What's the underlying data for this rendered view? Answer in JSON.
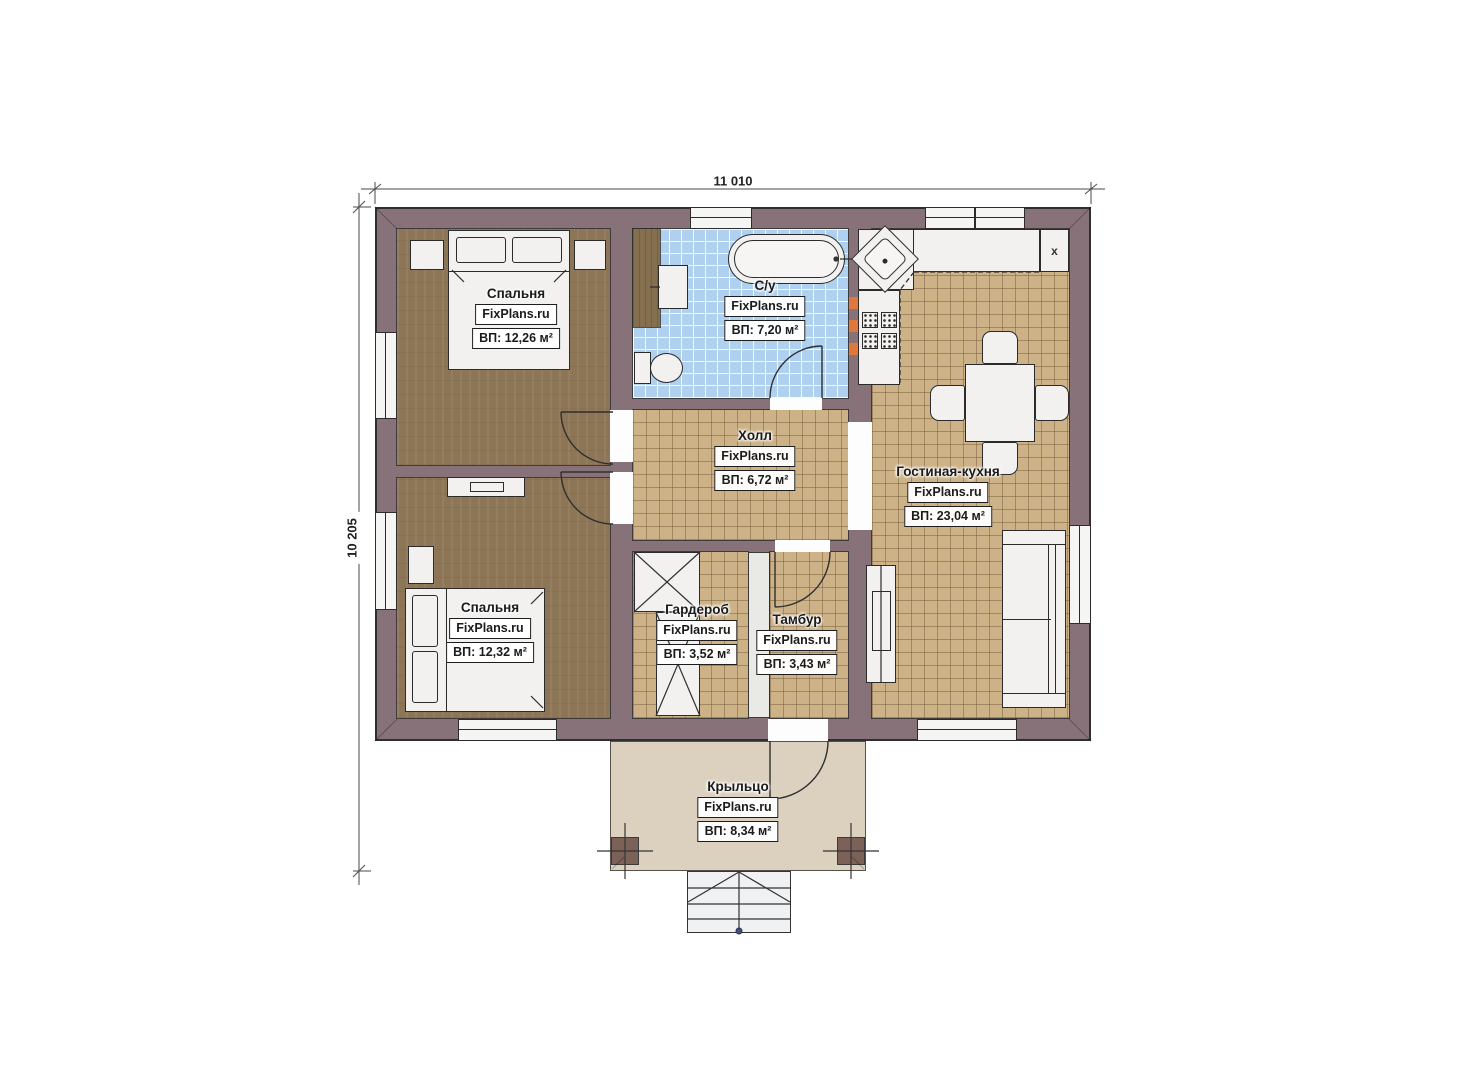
{
  "dimensions": {
    "width": "11 010",
    "height": "10 205"
  },
  "rooms": [
    {
      "id": "bedroom-top",
      "name": "Спальня",
      "brand": "FixPlans.ru",
      "area": "ВП: 12,26 м²"
    },
    {
      "id": "bathroom",
      "name": "С/у",
      "brand": "FixPlans.ru",
      "area": "ВП: 7,20 м²"
    },
    {
      "id": "hall",
      "name": "Холл",
      "brand": "FixPlans.ru",
      "area": "ВП: 6,72 м²"
    },
    {
      "id": "living-kitchen",
      "name": "Гостиная-кухня",
      "brand": "FixPlans.ru",
      "area": "ВП: 23,04 м²"
    },
    {
      "id": "bedroom-bottom",
      "name": "Спальня",
      "brand": "FixPlans.ru",
      "area": "ВП: 12,32 м²"
    },
    {
      "id": "wardrobe",
      "name": "Гардероб",
      "brand": "FixPlans.ru",
      "area": "ВП: 3,52 м²"
    },
    {
      "id": "tambour",
      "name": "Тамбур",
      "brand": "FixPlans.ru",
      "area": "ВП: 3,43 м²"
    },
    {
      "id": "porch",
      "name": "Крыльцо",
      "brand": "FixPlans.ru",
      "area": "ВП: 8,34 м²"
    }
  ],
  "markers": {
    "vent": "x"
  },
  "colors": {
    "wall": "#88727a",
    "wood_floor": "#8d7655",
    "tile_floor": "#cdb287",
    "bath_tile": "#b0d0f0",
    "porch": "#dcd1bf",
    "furniture": "#f2f1ef",
    "outline": "#2b2b2b",
    "accent": "#e0773b"
  }
}
